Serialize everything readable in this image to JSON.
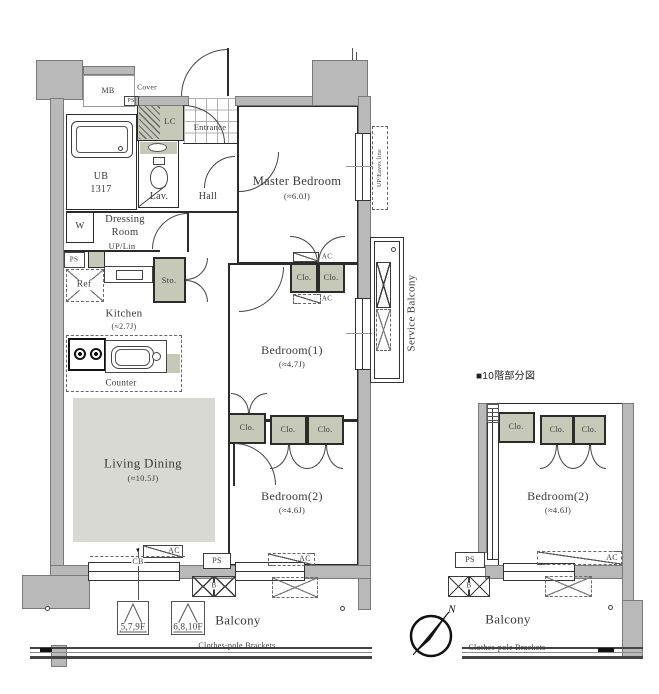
{
  "colors": {
    "wall": "#b9b9b9",
    "closet": "#c6c9b8",
    "living_fill": "#d9d9d3",
    "line": "#2b2b2b"
  },
  "labels": {
    "cover": "Cover",
    "mb": "MB",
    "ps": "PS",
    "lc": "LC",
    "entrance": "Entrance",
    "ub_line1": "UB",
    "ub_line2": "1317",
    "lav": "Lav.",
    "hall": "Hall",
    "dressing_line1": "Dressing",
    "dressing_line2": "Room",
    "up_lin": "UP/Lin",
    "w": "W",
    "ref": "Ref",
    "sto": "Sto.",
    "counter": "Counter",
    "clo": "Clo.",
    "ac": "AC",
    "cb": "CB",
    "cb_marker": "▼",
    "b_flue": "B",
    "up_eaves": "UP/Eaves line",
    "service_balcony": "Service Balcony",
    "balcony": "Balcony",
    "clothes_pole": "Clothes-pole Brackets",
    "floor_marker_1": "5,7,9F",
    "floor_marker_2": "6,8,10F",
    "compass_n": "N",
    "partial_title": "■10階部分図"
  },
  "rooms": {
    "master": {
      "name": "Master Bedroom",
      "size": "(≈6.0J)"
    },
    "bedroom1": {
      "name": "Bedroom(1)",
      "size": "(≈4.7J)"
    },
    "bedroom2": {
      "name": "Bedroom(2)",
      "size": "(≈4.6J)"
    },
    "living": {
      "name": "Living Dining",
      "size": "(≈10.5J)"
    },
    "kitchen": {
      "name": "Kitchen",
      "size": "(≈2.7J)"
    },
    "partial_bedroom2": {
      "name": "Bedroom(2)",
      "size": "(≈4.6J)"
    }
  }
}
